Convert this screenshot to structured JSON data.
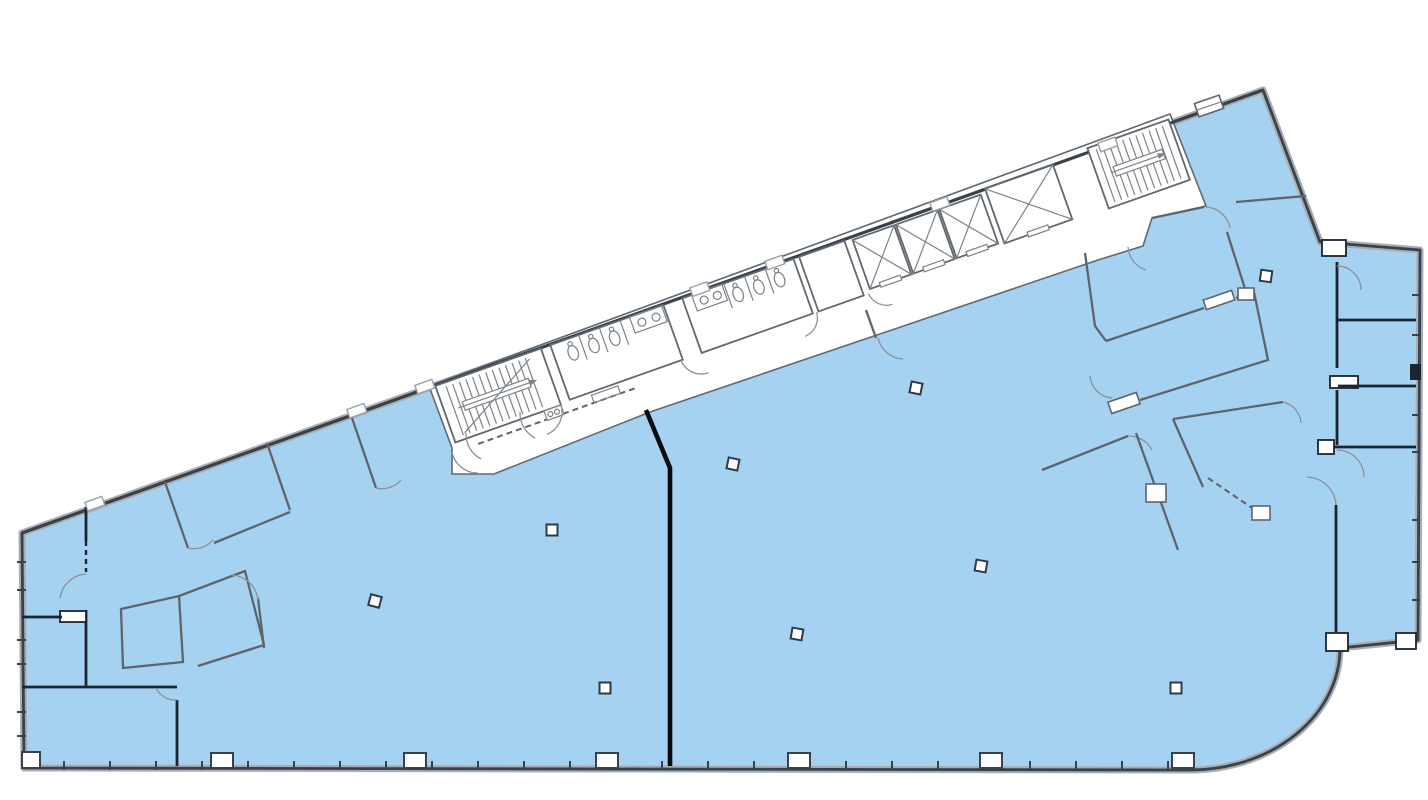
{
  "canvas": {
    "width": 1428,
    "height": 800
  },
  "colors": {
    "page_bg": "#ffffff",
    "space_fill": "#a6d2f2",
    "ext_wall_dark": "#3a4149",
    "ext_wall_light": "#a8adb3",
    "core_wall": "#61686f",
    "core_wall_light": "#9aa0a5",
    "partition": "#5d646b",
    "partition_bold": "#1a2530",
    "demising_wall": "#0b0b0b",
    "column_stroke": "#2e3a46",
    "fixture": "#7c8288",
    "door_arc": "#8a9096"
  },
  "plan": {
    "highlighted_suites": [
      {
        "name": "west-suite"
      },
      {
        "name": "east-suite"
      },
      {
        "name": "northeast-suite"
      },
      {
        "name": "east-wing-offices"
      }
    ],
    "core_elements": [
      "stairwell-west",
      "restroom-a",
      "restroom-b",
      "utility-room",
      "elevator-bank",
      "stairwell-east",
      "corridor",
      "kitchenette"
    ],
    "stairwells": [
      {
        "name": "stairwell-west",
        "x": 6,
        "y": 2,
        "w": 112,
        "h": 60,
        "tread_from": 16,
        "tread_to": 100,
        "tread_step": 7,
        "rail": {
          "x": 26,
          "y": 26,
          "w": 70,
          "h": 9
        },
        "diagonal": true
      },
      {
        "name": "stairwell-east",
        "x": 700,
        "y": -4,
        "w": 86,
        "h": 64,
        "tread_from": 708,
        "tread_to": 780,
        "tread_step": 7,
        "rail": {
          "x": 718,
          "y": 22,
          "w": 52,
          "h": 10
        },
        "diagonal": false
      }
    ],
    "restrooms": [
      {
        "name": "restroom-a",
        "x": 128,
        "y": 2,
        "w": 120,
        "h": 58,
        "stalls": [
          158,
          180,
          202
        ],
        "toilets": [
          147,
          169,
          191
        ],
        "counter": {
          "x": 212,
          "w": 34
        },
        "sinks": [
          222,
          237
        ]
      },
      {
        "name": "restroom-b",
        "x": 268,
        "y": 2,
        "w": 118,
        "h": 58,
        "stalls": [
          312,
          334,
          356
        ],
        "toilets": [
          322,
          344,
          366
        ],
        "counter": {
          "x": 278,
          "w": 32
        },
        "sinks": [
          288,
          302
        ]
      }
    ],
    "elevator_bank": {
      "shafts": [
        {
          "x": 448,
          "y": 4,
          "w": 44,
          "h": 52
        },
        {
          "x": 494,
          "y": 4,
          "w": 44,
          "h": 52
        },
        {
          "x": 540,
          "y": 4,
          "w": 44,
          "h": 52
        },
        {
          "x": 590,
          "y": 0,
          "w": 72,
          "h": 58
        }
      ]
    }
  },
  "structure": {
    "columns": [
      [
        375,
        601,
        15
      ],
      [
        552,
        530,
        0
      ],
      [
        605,
        688,
        0
      ],
      [
        733,
        464,
        12
      ],
      [
        797,
        634,
        10
      ],
      [
        916,
        388,
        12
      ],
      [
        981,
        566,
        10
      ],
      [
        1176,
        688,
        0
      ],
      [
        1266,
        276,
        8
      ]
    ],
    "pilasters": [
      222,
      415,
      607,
      799,
      991,
      1183
    ],
    "bottom_ticks": {
      "from": 64,
      "to": 1168,
      "step": 46,
      "y1": 761,
      "y2": 770
    },
    "left_ticks": {
      "x1": 17,
      "x2": 26,
      "ys": [
        562,
        590,
        640,
        664,
        712,
        736
      ]
    },
    "right_ticks": {
      "x1": 1412,
      "x2": 1420,
      "ys": [
        295,
        335,
        415,
        452,
        520,
        562,
        600
      ]
    },
    "window_tabs": {
      "xs": [
        95,
        357,
        425,
        700,
        775,
        940,
        1108
      ],
      "top_wall": {
        "x0": 22,
        "y0": 530,
        "slope": -0.3546
      },
      "angle": -19.53
    }
  }
}
